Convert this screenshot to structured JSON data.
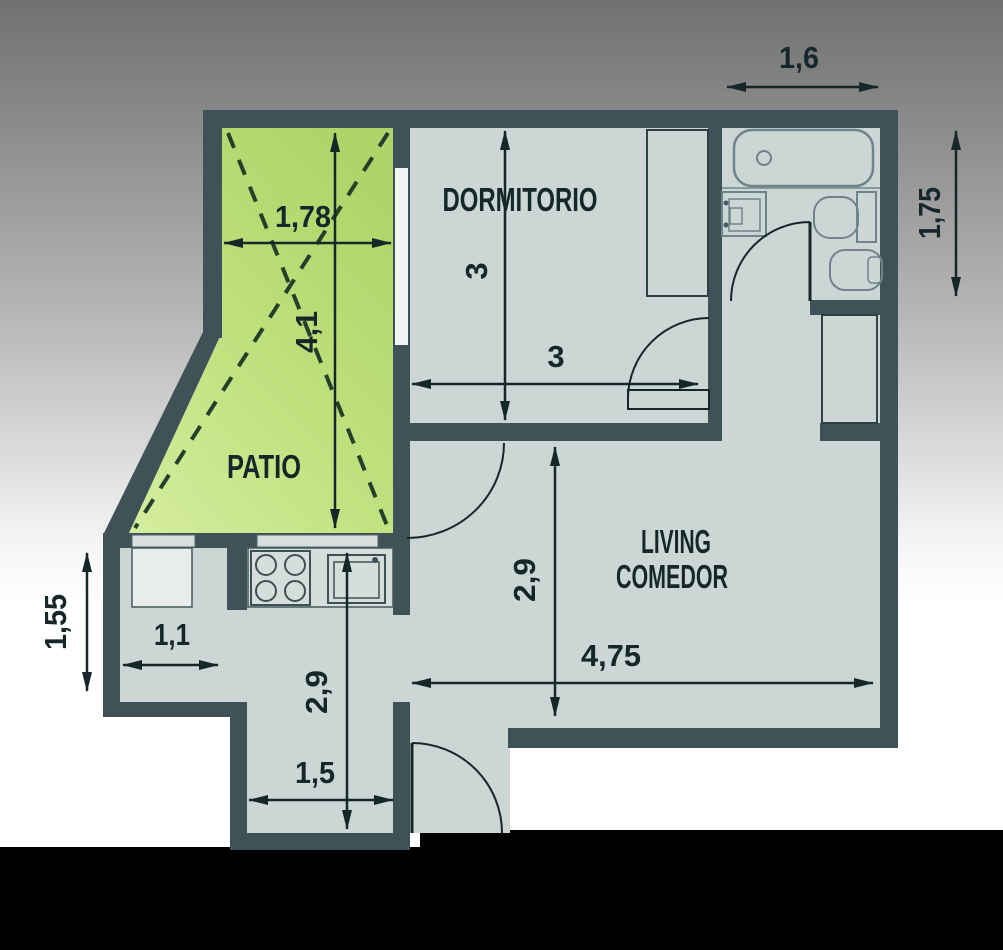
{
  "plan": {
    "type": "apartment-floor-plan",
    "rooms": {
      "dormitorio": {
        "label": "DORMITORIO",
        "width_label": "3",
        "height_label": "3"
      },
      "patio": {
        "label": "PATIO",
        "width_label": "1,78",
        "height_label": "4,1"
      },
      "living": {
        "label_line1": "LIVING",
        "label_line2": "COMEDOR",
        "width_label": "4,75",
        "height_label": "2,9"
      },
      "bathroom": {
        "width_label": "1,6",
        "height_label": "1,75"
      },
      "kitchen": {
        "nook_width_label": "1,1",
        "nook_height_label": "1,55",
        "corridor_width_label": "1,5",
        "corridor_height_label": "2,9"
      }
    },
    "fixtures": [
      "bathtub",
      "bathroom-sink",
      "toilet",
      "bidet",
      "wardrobe",
      "closet",
      "stove",
      "kitchen-sink",
      "kitchen-counter"
    ],
    "colors": {
      "wall": "#3f5257",
      "floor": "#ccd6d4",
      "patio_green_dark": "#aed56a",
      "patio_green_light": "#d5eda0",
      "background_top": "#717171",
      "background_bottom": "#ffffff",
      "bottom_bar": "#000000",
      "text": "#16272a"
    }
  }
}
